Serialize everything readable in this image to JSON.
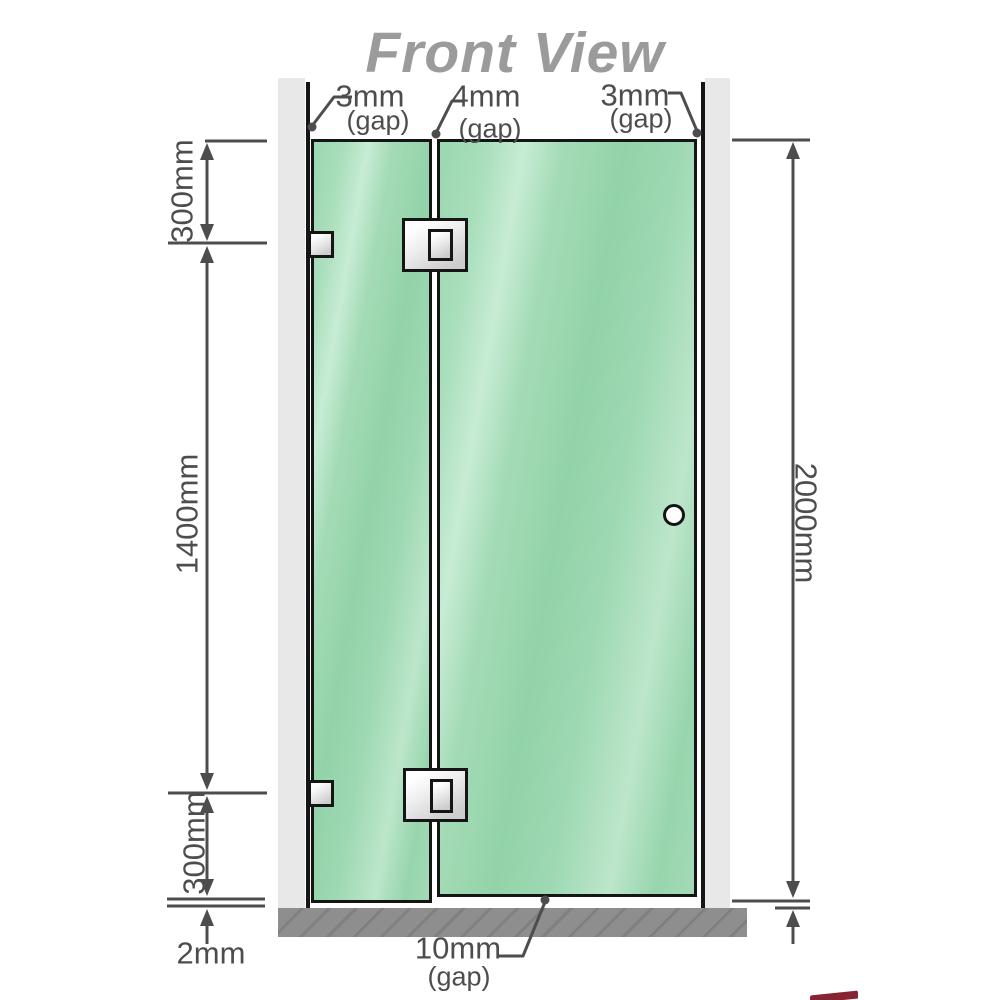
{
  "title": "Front View",
  "labels": {
    "gap_left": {
      "value": "3mm",
      "note": "(gap)"
    },
    "gap_middle": {
      "value": "4mm",
      "note": "(gap)"
    },
    "gap_right": {
      "value": "3mm",
      "note": "(gap)"
    },
    "gap_bottom": {
      "value": "10mm",
      "note": "(gap)"
    },
    "floor_gap": {
      "value": "2mm"
    }
  },
  "dimensions": {
    "left_top": "300mm",
    "left_middle": "1400mm",
    "left_bottom": "300mm",
    "right_full": "2000mm"
  },
  "colors": {
    "glass": "#9ed9b4",
    "wall_channel": "#e8e8e8",
    "floor": "#8e8e8e",
    "outline": "#151515",
    "dimension": "#4d4d4d",
    "title_gray": "#9b9b9b",
    "metal_light": "#ffffff",
    "metal_dark": "#cccccc",
    "watermark_red": "#7a0c1e"
  }
}
